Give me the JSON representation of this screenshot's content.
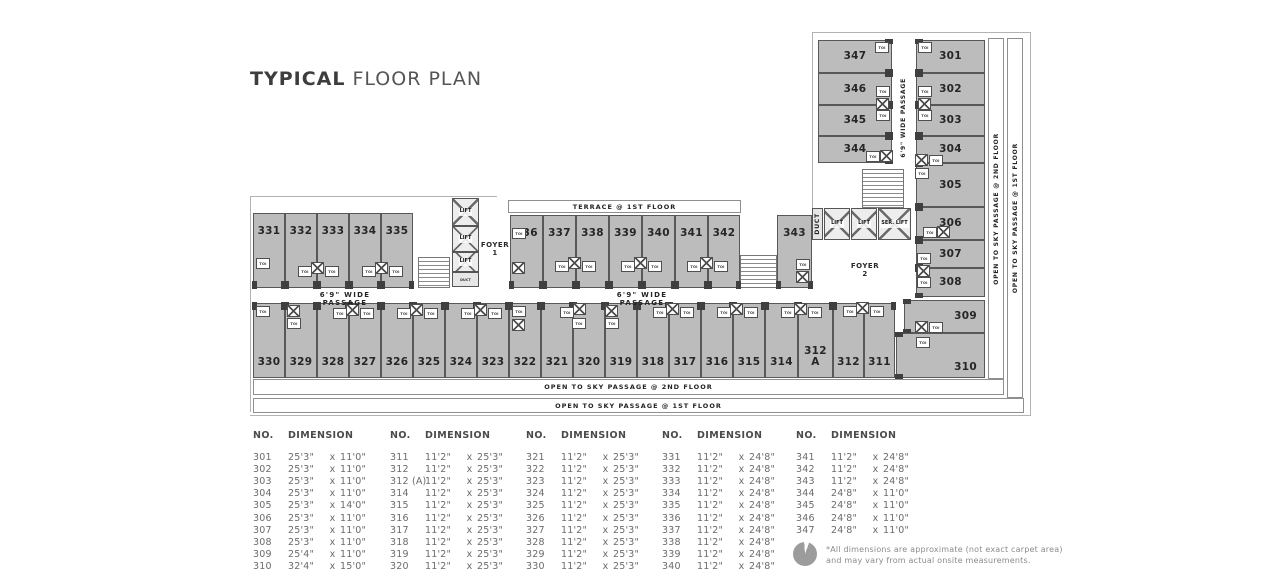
{
  "title": {
    "part_bold": "TYPICAL",
    "part_light": "FLOOR PLAN"
  },
  "plan": {
    "labels": {
      "toi": "TOI",
      "lift": "LIFT",
      "ser_lift": "SER. LIFT",
      "duct": "DUCT",
      "foyer1": "FOYER 1",
      "foyer2": "FOYER 2",
      "terrace": "TERRACE @ 1ST FLOOR",
      "wide_passage": "6'9\" WIDE PASSAGE",
      "sky_2nd": "OPEN TO SKY PASSAGE @ 2ND FLOOR",
      "sky_1st": "OPEN TO SKY PASSAGE @ 1ST FLOOR"
    },
    "rooms": [
      {
        "id": "347",
        "label": "347"
      },
      {
        "id": "346",
        "label": "346"
      },
      {
        "id": "345",
        "label": "345"
      },
      {
        "id": "344",
        "label": "344"
      },
      {
        "id": "301",
        "label": "301"
      },
      {
        "id": "302",
        "label": "302"
      },
      {
        "id": "303",
        "label": "303"
      },
      {
        "id": "304",
        "label": "304"
      },
      {
        "id": "305",
        "label": "305"
      },
      {
        "id": "306",
        "label": "306"
      },
      {
        "id": "307",
        "label": "307"
      },
      {
        "id": "308",
        "label": "308"
      },
      {
        "id": "309",
        "label": "309"
      },
      {
        "id": "310",
        "label": "310"
      },
      {
        "id": "331",
        "label": "331"
      },
      {
        "id": "332",
        "label": "332"
      },
      {
        "id": "333",
        "label": "333"
      },
      {
        "id": "334",
        "label": "334"
      },
      {
        "id": "335",
        "label": "335"
      },
      {
        "id": "336",
        "label": "336"
      },
      {
        "id": "337",
        "label": "337"
      },
      {
        "id": "338",
        "label": "338"
      },
      {
        "id": "339",
        "label": "339"
      },
      {
        "id": "340",
        "label": "340"
      },
      {
        "id": "341",
        "label": "341"
      },
      {
        "id": "342",
        "label": "342"
      },
      {
        "id": "343",
        "label": "343"
      },
      {
        "id": "330",
        "label": "330"
      },
      {
        "id": "329",
        "label": "329"
      },
      {
        "id": "328",
        "label": "328"
      },
      {
        "id": "327",
        "label": "327"
      },
      {
        "id": "326",
        "label": "326"
      },
      {
        "id": "325",
        "label": "325"
      },
      {
        "id": "324",
        "label": "324"
      },
      {
        "id": "323",
        "label": "323"
      },
      {
        "id": "322",
        "label": "322"
      },
      {
        "id": "321",
        "label": "321"
      },
      {
        "id": "320",
        "label": "320"
      },
      {
        "id": "319",
        "label": "319"
      },
      {
        "id": "318",
        "label": "318"
      },
      {
        "id": "317",
        "label": "317"
      },
      {
        "id": "316",
        "label": "316"
      },
      {
        "id": "315",
        "label": "315"
      },
      {
        "id": "314",
        "label": "314"
      },
      {
        "id": "312A",
        "label": "312 A"
      },
      {
        "id": "312",
        "label": "312"
      },
      {
        "id": "311",
        "label": "311"
      }
    ]
  },
  "table": {
    "no_header": "NO.",
    "dim_header": "DIMENSION",
    "sep": "x",
    "columns": [
      {
        "rows": [
          {
            "no": "301",
            "w": "25'3\"",
            "h": "11'0\""
          },
          {
            "no": "302",
            "w": "25'3\"",
            "h": "11'0\""
          },
          {
            "no": "303",
            "w": "25'3\"",
            "h": "11'0\""
          },
          {
            "no": "304",
            "w": "25'3\"",
            "h": "11'0\""
          },
          {
            "no": "305",
            "w": "25'3\"",
            "h": "14'0\""
          },
          {
            "no": "306",
            "w": "25'3\"",
            "h": "11'0\""
          },
          {
            "no": "307",
            "w": "25'3\"",
            "h": "11'0\""
          },
          {
            "no": "308",
            "w": "25'3\"",
            "h": "11'0\""
          },
          {
            "no": "309",
            "w": "25'4\"",
            "h": "11'0\""
          },
          {
            "no": "310",
            "w": "32'4\"",
            "h": "15'0\""
          }
        ]
      },
      {
        "rows": [
          {
            "no": "311",
            "w": "11'2\"",
            "h": "25'3\""
          },
          {
            "no": "312",
            "w": "11'2\"",
            "h": "25'3\""
          },
          {
            "no": "312 (A)",
            "w": "11'2\"",
            "h": "25'3\""
          },
          {
            "no": "314",
            "w": "11'2\"",
            "h": "25'3\""
          },
          {
            "no": "315",
            "w": "11'2\"",
            "h": "25'3\""
          },
          {
            "no": "316",
            "w": "11'2\"",
            "h": "25'3\""
          },
          {
            "no": "317",
            "w": "11'2\"",
            "h": "25'3\""
          },
          {
            "no": "318",
            "w": "11'2\"",
            "h": "25'3\""
          },
          {
            "no": "319",
            "w": "11'2\"",
            "h": "25'3\""
          },
          {
            "no": "320",
            "w": "11'2\"",
            "h": "25'3\""
          }
        ]
      },
      {
        "rows": [
          {
            "no": "321",
            "w": "11'2\"",
            "h": "25'3\""
          },
          {
            "no": "322",
            "w": "11'2\"",
            "h": "25'3\""
          },
          {
            "no": "323",
            "w": "11'2\"",
            "h": "25'3\""
          },
          {
            "no": "324",
            "w": "11'2\"",
            "h": "25'3\""
          },
          {
            "no": "325",
            "w": "11'2\"",
            "h": "25'3\""
          },
          {
            "no": "326",
            "w": "11'2\"",
            "h": "25'3\""
          },
          {
            "no": "327",
            "w": "11'2\"",
            "h": "25'3\""
          },
          {
            "no": "328",
            "w": "11'2\"",
            "h": "25'3\""
          },
          {
            "no": "329",
            "w": "11'2\"",
            "h": "25'3\""
          },
          {
            "no": "330",
            "w": "11'2\"",
            "h": "25'3\""
          }
        ]
      },
      {
        "rows": [
          {
            "no": "331",
            "w": "11'2\"",
            "h": "24'8\""
          },
          {
            "no": "332",
            "w": "11'2\"",
            "h": "24'8\""
          },
          {
            "no": "333",
            "w": "11'2\"",
            "h": "24'8\""
          },
          {
            "no": "334",
            "w": "11'2\"",
            "h": "24'8\""
          },
          {
            "no": "335",
            "w": "11'2\"",
            "h": "24'8\""
          },
          {
            "no": "336",
            "w": "11'2\"",
            "h": "24'8\""
          },
          {
            "no": "337",
            "w": "11'2\"",
            "h": "24'8\""
          },
          {
            "no": "338",
            "w": "11'2\"",
            "h": "24'8\""
          },
          {
            "no": "339",
            "w": "11'2\"",
            "h": "24'8\""
          },
          {
            "no": "340",
            "w": "11'2\"",
            "h": "24'8\""
          }
        ]
      },
      {
        "rows": [
          {
            "no": "341",
            "w": "11'2\"",
            "h": "24'8\""
          },
          {
            "no": "342",
            "w": "11'2\"",
            "h": "24'8\""
          },
          {
            "no": "343",
            "w": "11'2\"",
            "h": "24'8\""
          },
          {
            "no": "344",
            "w": "24'8\"",
            "h": "11'0\""
          },
          {
            "no": "345",
            "w": "24'8\"",
            "h": "11'0\""
          },
          {
            "no": "346",
            "w": "24'8\"",
            "h": "11'0\""
          },
          {
            "no": "347",
            "w": "24'8\"",
            "h": "11'0\""
          }
        ]
      }
    ],
    "footnote_line1": "*All dimensions are approximate (not exact carpet area)",
    "footnote_line2": "and may vary from actual onsite measurements."
  }
}
